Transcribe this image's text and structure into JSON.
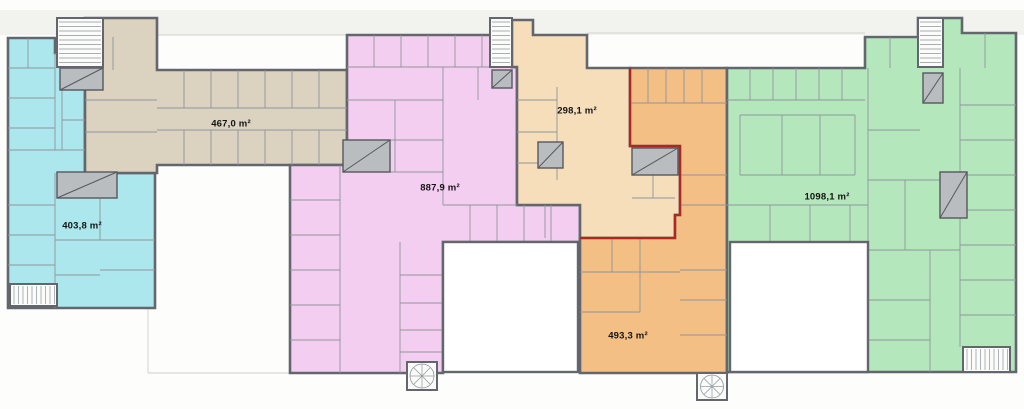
{
  "floorplan": {
    "canvas": {
      "width": 1024,
      "height": 409,
      "background": "#fdfdfc",
      "roof_band_color": "#f2f2ef",
      "wall_color": "#63666c",
      "partition_color": "#8f959b",
      "faint_line_color": "#d9d9d4",
      "courtyard_color": "#ffffff",
      "stair_fill": "#fbfbfa",
      "shaft_fill": "#b9bdc0",
      "shaft_border": "#55585c",
      "selection_color": "#b3261e"
    },
    "zones": [
      {
        "id": "unit-west-cyan",
        "area_label": "403,8 m²",
        "color": "#abe7ed",
        "label_pos": [
          82,
          226
        ],
        "polygon": [
          [
            8,
            38
          ],
          [
            55,
            38
          ],
          [
            55,
            53
          ],
          [
            85,
            53
          ],
          [
            85,
            173
          ],
          [
            155,
            173
          ],
          [
            155,
            308
          ],
          [
            8,
            308
          ]
        ]
      },
      {
        "id": "unit-northwest-tan",
        "area_label": "467,0 m²",
        "color": "#dbd2c0",
        "label_pos": [
          231,
          124
        ],
        "polygon": [
          [
            85,
            18
          ],
          [
            157,
            18
          ],
          [
            157,
            70
          ],
          [
            347,
            70
          ],
          [
            347,
            165
          ],
          [
            157,
            165
          ],
          [
            157,
            173
          ],
          [
            85,
            173
          ]
        ]
      },
      {
        "id": "unit-central-pink",
        "area_label": "887,9 m²",
        "color": "#f4cef1",
        "label_pos": [
          440,
          188
        ],
        "polygon": [
          [
            347,
            35
          ],
          [
            512,
            35
          ],
          [
            512,
            67
          ],
          [
            517,
            67
          ],
          [
            517,
            205
          ],
          [
            580,
            205
          ],
          [
            580,
            242
          ],
          [
            443,
            242
          ],
          [
            443,
            373
          ],
          [
            290,
            373
          ],
          [
            290,
            165
          ],
          [
            347,
            165
          ]
        ]
      },
      {
        "id": "unit-north-peach",
        "area_label": "298,1 m²",
        "color": "#f7debb",
        "label_pos": [
          577,
          111
        ],
        "polygon": [
          [
            512,
            20
          ],
          [
            533,
            20
          ],
          [
            533,
            35
          ],
          [
            587,
            35
          ],
          [
            587,
            68
          ],
          [
            630,
            68
          ],
          [
            630,
            146
          ],
          [
            680,
            146
          ],
          [
            680,
            215
          ],
          [
            675,
            215
          ],
          [
            675,
            238
          ],
          [
            580,
            238
          ],
          [
            580,
            205
          ],
          [
            517,
            205
          ],
          [
            517,
            67
          ],
          [
            512,
            67
          ]
        ]
      },
      {
        "id": "unit-south-orange",
        "area_label": "493,3 m²",
        "color": "#f3bf85",
        "label_pos": [
          628,
          336
        ],
        "polygon": [
          [
            630,
            68
          ],
          [
            727,
            68
          ],
          [
            727,
            373
          ],
          [
            580,
            373
          ],
          [
            580,
            238
          ],
          [
            675,
            238
          ],
          [
            675,
            215
          ],
          [
            680,
            215
          ],
          [
            680,
            146
          ],
          [
            630,
            146
          ]
        ]
      },
      {
        "id": "unit-east-green",
        "area_label": "1098,1 m²",
        "color": "#b5e7bd",
        "label_pos": [
          827,
          197
        ],
        "polygon": [
          [
            727,
            68
          ],
          [
            865,
            68
          ],
          [
            865,
            37
          ],
          [
            918,
            37
          ],
          [
            918,
            18
          ],
          [
            962,
            18
          ],
          [
            962,
            33
          ],
          [
            1016,
            33
          ],
          [
            1016,
            372
          ],
          [
            727,
            372
          ]
        ]
      }
    ],
    "selected_unit_boundary": [
      [
        630,
        68
      ],
      [
        630,
        146
      ],
      [
        680,
        146
      ],
      [
        680,
        215
      ],
      [
        675,
        215
      ],
      [
        675,
        238
      ],
      [
        580,
        238
      ]
    ],
    "courtyards": [
      {
        "id": "courtyard-west",
        "rect": [
          443,
          242,
          135,
          130
        ]
      },
      {
        "id": "courtyard-east",
        "rect": [
          730,
          242,
          138,
          130
        ]
      }
    ],
    "roof_band": [
      0,
      10,
      1024,
      25
    ],
    "parapet_lines": [
      [
        157,
        35,
        437,
        35
      ],
      [
        587,
        33,
        865,
        33
      ]
    ],
    "terrace_lines": [
      [
        148,
        306,
        148,
        373
      ],
      [
        148,
        373,
        290,
        373
      ],
      [
        443,
        372,
        580,
        372
      ],
      [
        730,
        372,
        868,
        372
      ]
    ],
    "stairwells": [
      {
        "id": "stair-nw",
        "rect": [
          57,
          18,
          46,
          49
        ],
        "type": "straight",
        "dir": "h"
      },
      {
        "id": "stair-sw",
        "rect": [
          10,
          284,
          47,
          22
        ],
        "type": "straight",
        "dir": "v"
      },
      {
        "id": "stair-mid-north",
        "rect": [
          490,
          18,
          22,
          49
        ],
        "type": "straight",
        "dir": "h"
      },
      {
        "id": "stair-ne",
        "rect": [
          918,
          18,
          25,
          49
        ],
        "type": "straight",
        "dir": "h"
      },
      {
        "id": "stair-se",
        "rect": [
          963,
          347,
          47,
          25
        ],
        "type": "straight",
        "dir": "v"
      },
      {
        "id": "stair-spiral-central",
        "rect": [
          407,
          362,
          30,
          28
        ],
        "type": "spiral"
      },
      {
        "id": "stair-spiral-south",
        "rect": [
          697,
          373,
          30,
          27
        ],
        "type": "spiral"
      }
    ],
    "shafts": [
      [
        60,
        68,
        43,
        22
      ],
      [
        492,
        70,
        20,
        18
      ],
      [
        923,
        73,
        20,
        30
      ],
      [
        57,
        172,
        60,
        26
      ],
      [
        343,
        140,
        47,
        32
      ],
      [
        538,
        142,
        25,
        26
      ],
      [
        632,
        148,
        46,
        27
      ],
      [
        940,
        172,
        27,
        46
      ]
    ],
    "partitions": [
      [
        157,
        108,
        347,
        108
      ],
      [
        157,
        130,
        347,
        130
      ],
      [
        184,
        70,
        184,
        108
      ],
      [
        211,
        70,
        211,
        108
      ],
      [
        238,
        70,
        238,
        108
      ],
      [
        265,
        70,
        265,
        108
      ],
      [
        292,
        70,
        292,
        108
      ],
      [
        319,
        70,
        319,
        108
      ],
      [
        184,
        130,
        184,
        165
      ],
      [
        211,
        130,
        211,
        165
      ],
      [
        238,
        130,
        238,
        165
      ],
      [
        265,
        130,
        265,
        165
      ],
      [
        292,
        130,
        292,
        165
      ],
      [
        319,
        130,
        319,
        165
      ],
      [
        85,
        100,
        157,
        100
      ],
      [
        85,
        132,
        157,
        132
      ],
      [
        113,
        37,
        113,
        70
      ],
      [
        8,
        68,
        55,
        68
      ],
      [
        8,
        98,
        55,
        98
      ],
      [
        8,
        128,
        55,
        128
      ],
      [
        8,
        150,
        85,
        150
      ],
      [
        28,
        38,
        28,
        68
      ],
      [
        55,
        53,
        55,
        150
      ],
      [
        62,
        90,
        62,
        150
      ],
      [
        62,
        120,
        85,
        120
      ],
      [
        55,
        173,
        55,
        308
      ],
      [
        8,
        205,
        55,
        205
      ],
      [
        8,
        235,
        55,
        235
      ],
      [
        8,
        265,
        55,
        265
      ],
      [
        55,
        240,
        155,
        240
      ],
      [
        100,
        173,
        100,
        240
      ],
      [
        100,
        270,
        155,
        270
      ],
      [
        55,
        275,
        100,
        275
      ],
      [
        374,
        35,
        374,
        67
      ],
      [
        401,
        35,
        401,
        67
      ],
      [
        428,
        35,
        428,
        67
      ],
      [
        455,
        35,
        455,
        67
      ],
      [
        482,
        35,
        482,
        67
      ],
      [
        347,
        67,
        512,
        67
      ],
      [
        347,
        100,
        443,
        100
      ],
      [
        347,
        140,
        443,
        140
      ],
      [
        395,
        100,
        395,
        140
      ],
      [
        347,
        172,
        443,
        172
      ],
      [
        395,
        140,
        395,
        172
      ],
      [
        443,
        67,
        443,
        205
      ],
      [
        478,
        67,
        478,
        100
      ],
      [
        470,
        205,
        470,
        242
      ],
      [
        497,
        205,
        497,
        242
      ],
      [
        524,
        205,
        524,
        242
      ],
      [
        551,
        205,
        551,
        242
      ],
      [
        443,
        205,
        517,
        205
      ],
      [
        340,
        165,
        340,
        373
      ],
      [
        290,
        200,
        340,
        200
      ],
      [
        290,
        235,
        340,
        235
      ],
      [
        290,
        270,
        340,
        270
      ],
      [
        290,
        305,
        340,
        305
      ],
      [
        290,
        340,
        340,
        340
      ],
      [
        400,
        242,
        400,
        373
      ],
      [
        400,
        275,
        443,
        275
      ],
      [
        400,
        303,
        443,
        303
      ],
      [
        400,
        330,
        443,
        330
      ],
      [
        400,
        352,
        443,
        352
      ],
      [
        517,
        100,
        557,
        100
      ],
      [
        517,
        132,
        557,
        132
      ],
      [
        517,
        163,
        557,
        163
      ],
      [
        557,
        87,
        557,
        180
      ],
      [
        545,
        205,
        545,
        238
      ],
      [
        632,
        198,
        675,
        198
      ],
      [
        653,
        175,
        653,
        198
      ],
      [
        648,
        68,
        648,
        103
      ],
      [
        666,
        68,
        666,
        103
      ],
      [
        684,
        68,
        684,
        103
      ],
      [
        702,
        68,
        702,
        103
      ],
      [
        630,
        103,
        727,
        103
      ],
      [
        680,
        175,
        727,
        175
      ],
      [
        680,
        205,
        727,
        205
      ],
      [
        680,
        270,
        727,
        270
      ],
      [
        680,
        300,
        727,
        300
      ],
      [
        680,
        335,
        727,
        335
      ],
      [
        612,
        238,
        612,
        272
      ],
      [
        640,
        238,
        640,
        272
      ],
      [
        580,
        272,
        680,
        272
      ],
      [
        580,
        312,
        640,
        312
      ],
      [
        640,
        272,
        640,
        312
      ],
      [
        750,
        68,
        750,
        100
      ],
      [
        773,
        68,
        773,
        100
      ],
      [
        796,
        68,
        796,
        100
      ],
      [
        819,
        68,
        819,
        100
      ],
      [
        842,
        68,
        842,
        100
      ],
      [
        727,
        100,
        865,
        100
      ],
      [
        740,
        115,
        855,
        115
      ],
      [
        740,
        175,
        855,
        175
      ],
      [
        782,
        115,
        782,
        175
      ],
      [
        820,
        115,
        820,
        175
      ],
      [
        740,
        115,
        740,
        175
      ],
      [
        855,
        115,
        855,
        175
      ],
      [
        770,
        205,
        770,
        242
      ],
      [
        810,
        205,
        810,
        242
      ],
      [
        850,
        205,
        850,
        242
      ],
      [
        727,
        205,
        868,
        205
      ],
      [
        868,
        68,
        868,
        372
      ],
      [
        890,
        37,
        890,
        68
      ],
      [
        985,
        33,
        985,
        68
      ],
      [
        960,
        68,
        960,
        347
      ],
      [
        960,
        105,
        1016,
        105
      ],
      [
        960,
        140,
        1016,
        140
      ],
      [
        960,
        175,
        1016,
        175
      ],
      [
        960,
        210,
        1016,
        210
      ],
      [
        960,
        245,
        1016,
        245
      ],
      [
        960,
        280,
        1016,
        280
      ],
      [
        960,
        315,
        1016,
        315
      ],
      [
        868,
        130,
        920,
        130
      ],
      [
        868,
        180,
        960,
        180
      ],
      [
        905,
        180,
        905,
        250
      ],
      [
        868,
        250,
        960,
        250
      ],
      [
        868,
        300,
        930,
        300
      ],
      [
        868,
        340,
        930,
        340
      ],
      [
        930,
        250,
        930,
        372
      ]
    ]
  }
}
